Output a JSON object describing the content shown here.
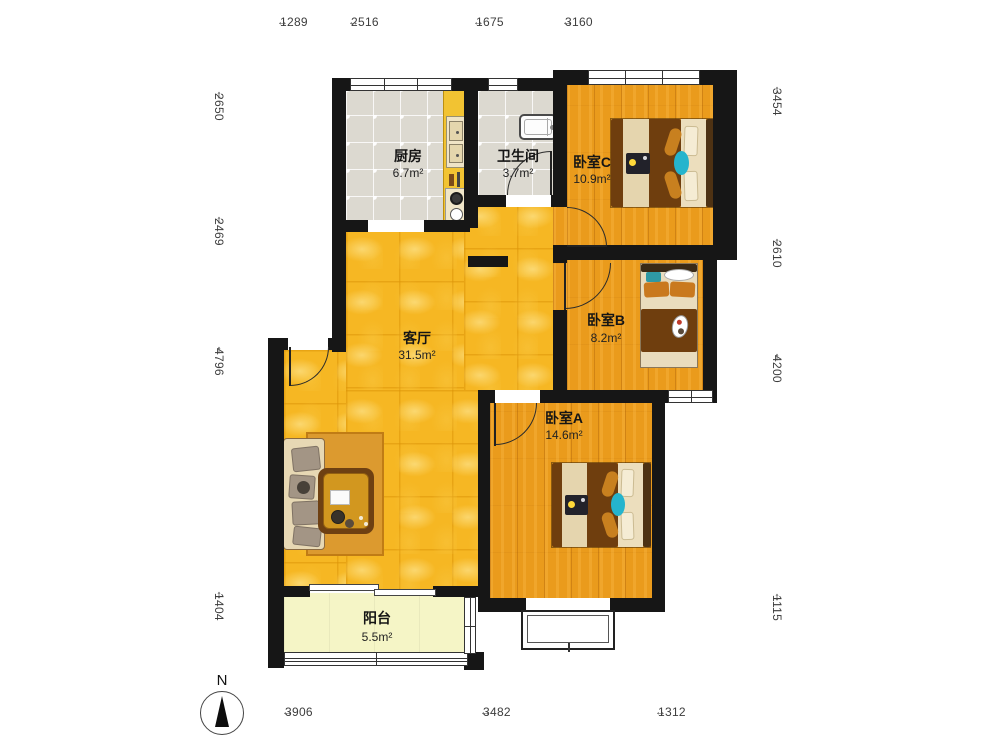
{
  "compass": {
    "label": "N"
  },
  "rooms": {
    "kitchen": {
      "name": "厨房",
      "area": "6.7m²"
    },
    "bathroom": {
      "name": "卫生间",
      "area": "3.7m²"
    },
    "bedroom_c": {
      "name": "卧室C",
      "area": "10.9m²"
    },
    "bedroom_b": {
      "name": "卧室B",
      "area": "8.2m²"
    },
    "bedroom_a": {
      "name": "卧室A",
      "area": "14.6m²"
    },
    "living_room": {
      "name": "客厅",
      "area": "31.5m²"
    },
    "balcony": {
      "name": "阳台",
      "area": "5.5m²"
    }
  },
  "dimensions": {
    "top": [
      {
        "label": "1289"
      },
      {
        "label": "2516"
      },
      {
        "label": "1675"
      },
      {
        "label": "3160"
      }
    ],
    "left": [
      {
        "label": "2650"
      },
      {
        "label": "2469"
      },
      {
        "label": "4796"
      },
      {
        "label": "1404"
      }
    ],
    "right": [
      {
        "label": "3454"
      },
      {
        "label": "2610"
      },
      {
        "label": "4200"
      },
      {
        "label": "1115"
      }
    ],
    "bottom": [
      {
        "label": "3906"
      },
      {
        "label": "3482"
      },
      {
        "label": "1312"
      }
    ]
  },
  "colors": {
    "wall": "#161616",
    "living_floor": "#f6b723",
    "bedroom_floor": "#ea9b1c",
    "kitchen_floor": "#dcd9d0",
    "balcony_floor": "#f5f5c6"
  }
}
